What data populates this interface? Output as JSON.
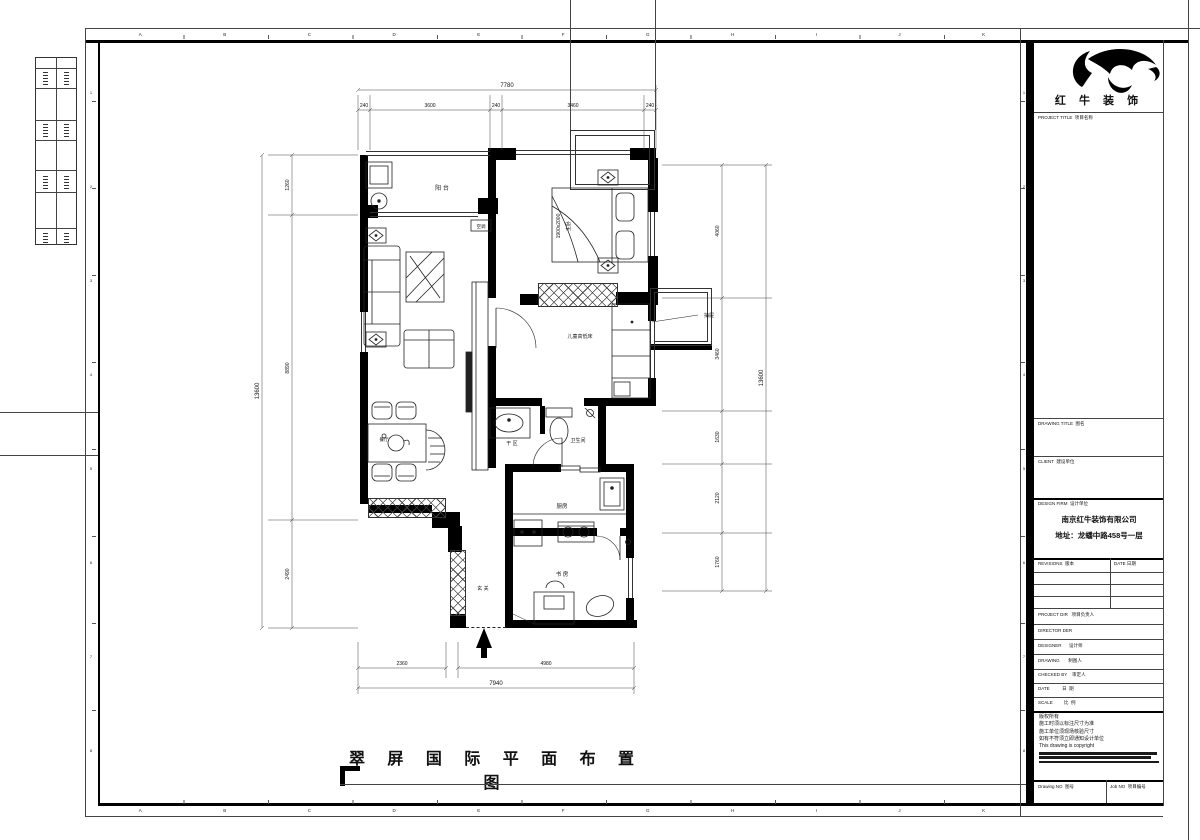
{
  "grid": {
    "letters": [
      "A",
      "B",
      "C",
      "D",
      "E",
      "F",
      "G",
      "H",
      "I",
      "J",
      "K"
    ],
    "numbers": [
      "1",
      "2",
      "3",
      "4",
      "5",
      "6",
      "7",
      "8"
    ]
  },
  "plan": {
    "labels": {
      "balcony": "阳  台",
      "master_bed_size": "1900x2000",
      "master_bedroom": "主卧",
      "kids_bed": "儿童高低床",
      "drawer": "抽屉",
      "ac": "空调",
      "dry_area": "干 区",
      "bathroom": "卫生间",
      "kitchen": "厨房",
      "study": "书  房",
      "entry": "玄  关",
      "dining": "餐厅"
    },
    "dims": {
      "top_total": "7780",
      "top_seg_1": "240",
      "top_seg_2": "3600",
      "top_seg_3": "240",
      "top_seg_4": "3460",
      "top_seg_5": "240",
      "left_total": "13600",
      "left_seg_1": "1260",
      "left_seg_2": "8890",
      "left_seg_3": "2490",
      "right_total": "13600",
      "right_seg_1": "4060",
      "right_seg_2": "3460",
      "right_seg_3": "1630",
      "right_seg_4": "2120",
      "right_seg_5": "1760",
      "bottom_total": "7940",
      "bottom_seg_1": "2360",
      "bottom_seg_2": "4980"
    }
  },
  "sheet_title": "翠 屏 国 际 平 面 布 置 图",
  "titleblock": {
    "logo": "红 牛 装 饰",
    "project_title": "PROJECT TITLE  项目名称",
    "drawing_title": "DRAWING TITLE  图名",
    "client": "CLIENT  建设单位",
    "design_firm": "DESIGN FIRM  设计单位",
    "firm_name": "南京红牛装饰有限公司",
    "firm_address": "地址：龙蟠中路458号一层",
    "revisions": "REVISIONS  版本",
    "rev_date": "DATE 日期",
    "project_dir": "PROJECT DIR   项目负责人",
    "director": "DIRECTOR DER",
    "designer": "DESIGNER      设计师",
    "drawing": "DRAWING       制图人",
    "checked_by": "CHECKED BY    审定人",
    "date": "DATE          日  期",
    "scale": "SCALE         比  例",
    "copyright_lines": [
      "版权所有",
      "施工时须以标注尺寸为准",
      "施工单位须现场核验尺寸",
      "如有不符须立即通知设计单位",
      "This drawing is copyright"
    ],
    "drawing_no": "Drawing NO  图号",
    "job_no": "Job NO  项目编号"
  }
}
